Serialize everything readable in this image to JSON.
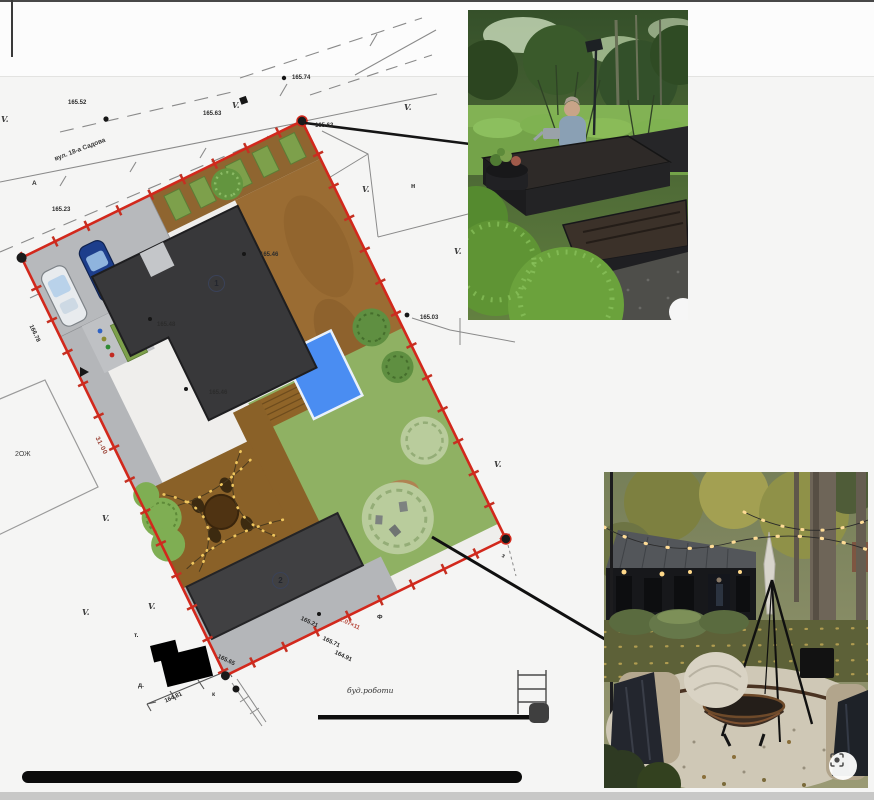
{
  "page": {
    "background": "#f5f5f4",
    "bottom_band_color": "#c8c8c7",
    "redaction_color": "#0b0b0b"
  },
  "plan": {
    "street_label": "вул. 18-а Садова",
    "survey_mark": "V.",
    "building1_label": "1",
    "building2_label": "2",
    "colors": {
      "boundary_red": "#d2281c",
      "lawn_green": "#8fb163",
      "pool_blue": "#4a8df2",
      "deck_brown": "#8a6128",
      "building_gray": "#3a3a3c",
      "parking_gray": "#b7b9bc"
    },
    "labels": [
      {
        "text": "165.74"
      },
      {
        "text": "165.52"
      },
      {
        "text": "165.63"
      },
      {
        "text": "165.63"
      },
      {
        "text": "165.23"
      },
      {
        "text": "А"
      },
      {
        "text": "н"
      },
      {
        "text": "165.46"
      },
      {
        "text": "165.48"
      },
      {
        "text": "165.46"
      },
      {
        "text": "165.03"
      },
      {
        "text": "166.78"
      },
      {
        "text": "31-00"
      },
      {
        "text": "2ОЖ"
      },
      {
        "text": "165.21"
      },
      {
        "text": "2.07×11"
      },
      {
        "text": "165.71"
      },
      {
        "text": "164.91"
      },
      {
        "text": "165.65"
      },
      {
        "text": "164.81"
      },
      {
        "text": "т."
      },
      {
        "text": "д."
      },
      {
        "text": "к"
      },
      {
        "text": "Ф"
      },
      {
        "text": "буд.роботи"
      },
      {
        "text": "вул. 18-а Садова"
      },
      {
        "text": "з"
      }
    ]
  },
  "photos": {
    "garden": {
      "name": "raised-garden-beds-photo"
    },
    "firepit": {
      "name": "fire-pit-patio-photo"
    }
  },
  "icons": {
    "lens_icon": "visual-search"
  }
}
